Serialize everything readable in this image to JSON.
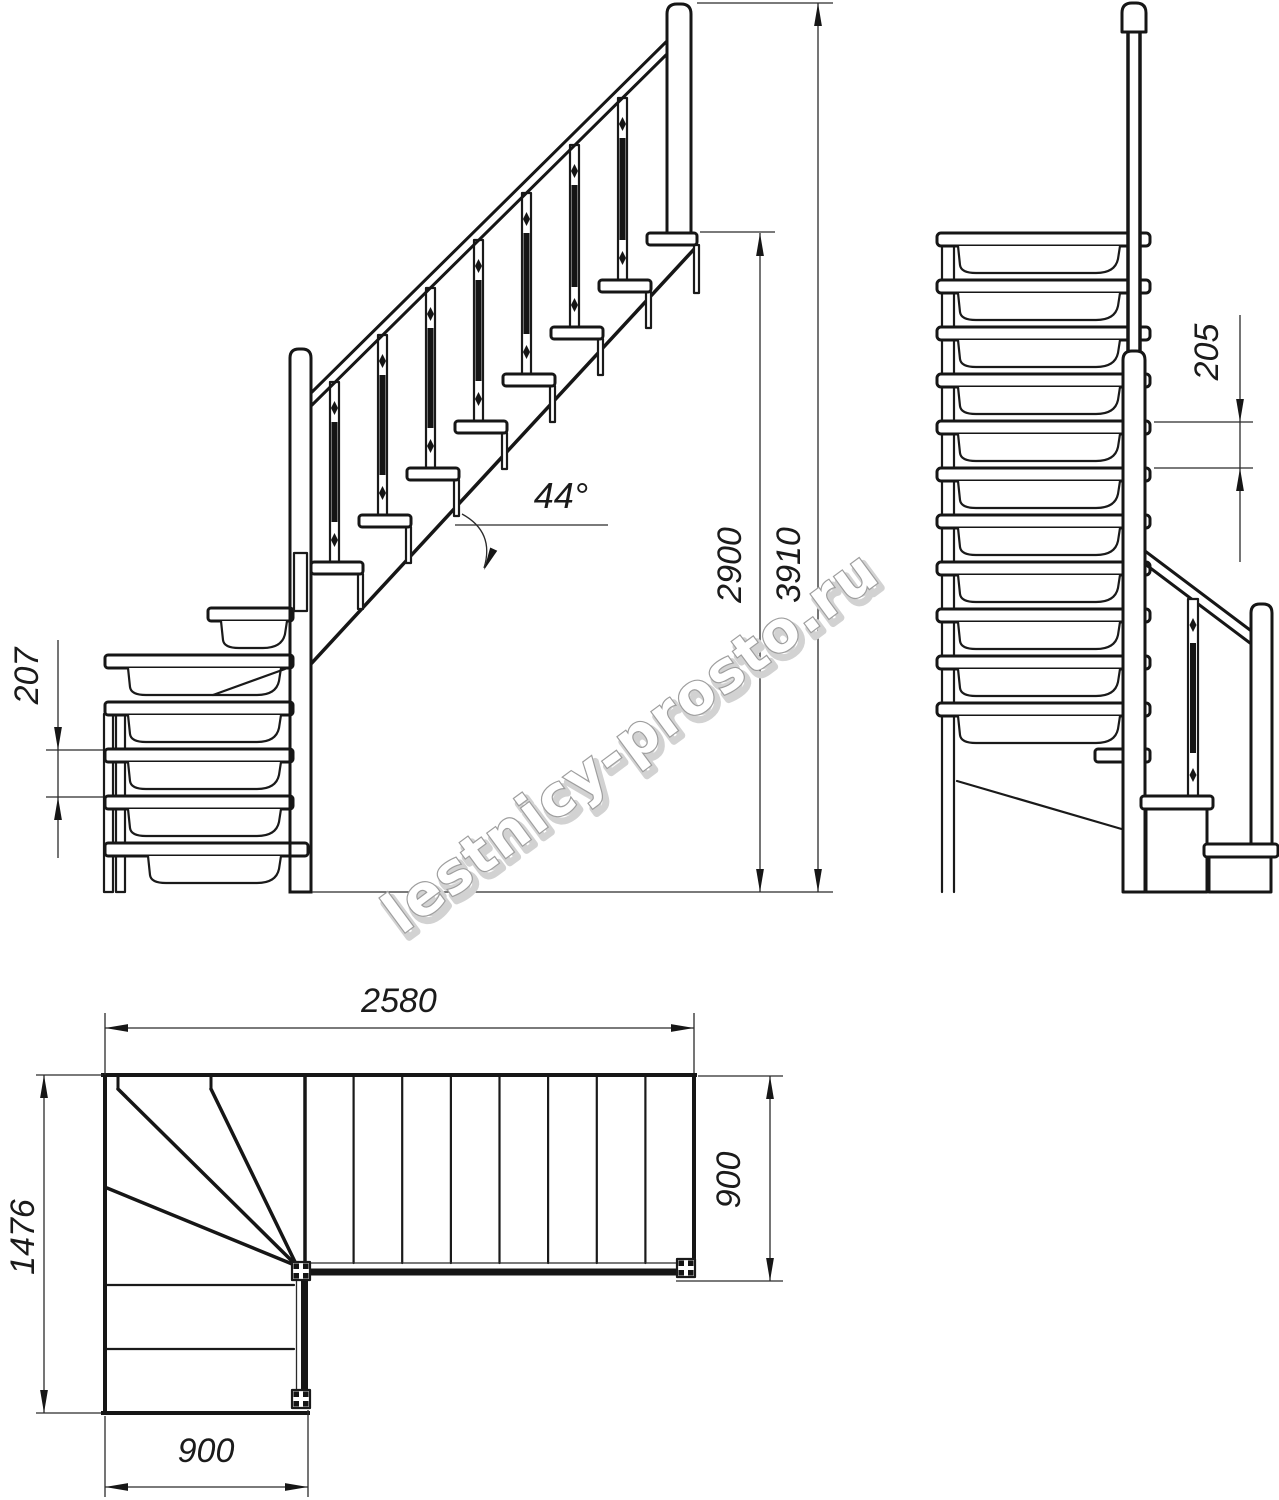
{
  "drawing": {
    "watermark": "lestnicy-prosto.ru",
    "angle": "44°",
    "dims": {
      "total_run": "2580",
      "plan_depth": "1476",
      "flight_width_bottom": "900",
      "flight_width_right": "900",
      "landing_height": "2900",
      "total_height": "3910",
      "winder_rise": "207",
      "straight_rise": "205"
    }
  }
}
